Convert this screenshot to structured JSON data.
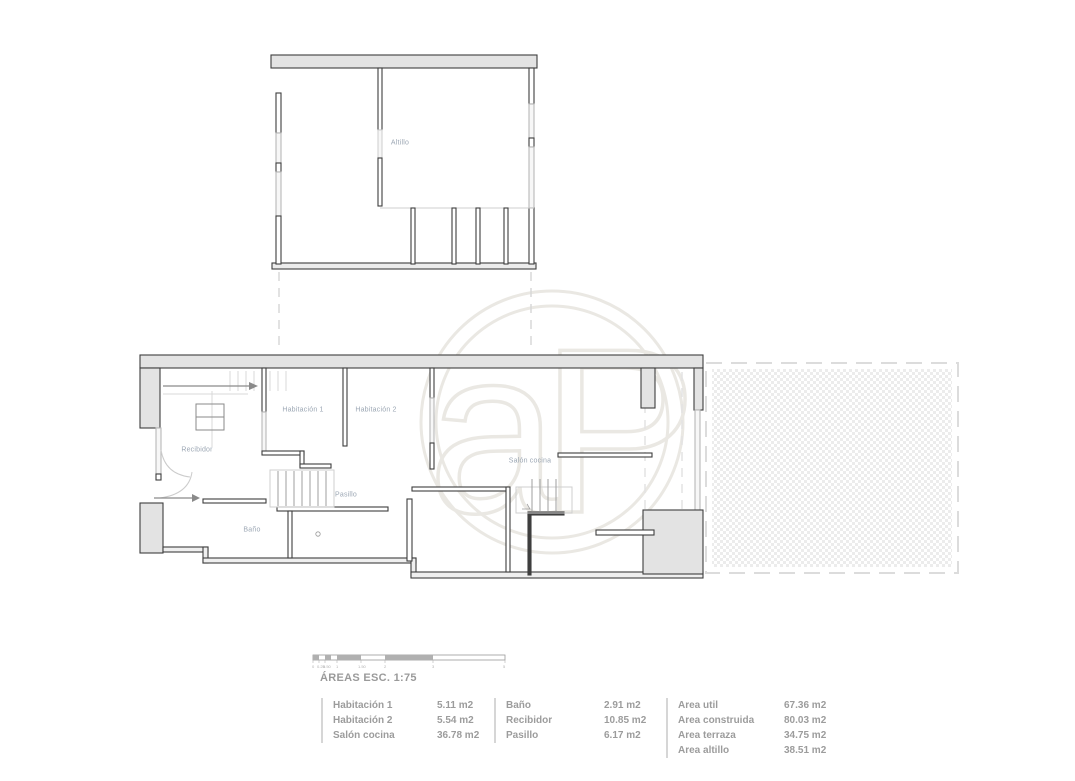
{
  "page": {
    "background": "#ffffff",
    "width": 1075,
    "height": 781
  },
  "watermark": {
    "letters": "aP",
    "color": "#eae8e3"
  },
  "plans": {
    "altillo": {
      "label": "Altillo"
    },
    "main": {
      "rooms": [
        {
          "name": "recibidor",
          "label": "Recibidor"
        },
        {
          "name": "habitacion-1",
          "label": "Habitación 1"
        },
        {
          "name": "habitacion-2",
          "label": "Habitación 2"
        },
        {
          "name": "pasillo",
          "label": "Pasillo"
        },
        {
          "name": "bano",
          "label": "Baño"
        },
        {
          "name": "salon-cocina",
          "label": "Salón cocina"
        }
      ]
    }
  },
  "legend": {
    "title": "ÁREAS ESC. 1:75",
    "scale_ticks": [
      "0",
      "0.25",
      "0.50",
      "1",
      "1.50",
      "2",
      "3",
      "5"
    ],
    "columns": [
      {
        "rows": [
          {
            "label": "Habitación 1",
            "value": "5.11 m2"
          },
          {
            "label": "Habitación 2",
            "value": "5.54 m2"
          },
          {
            "label": "Salón cocina",
            "value": "36.78 m2"
          }
        ]
      },
      {
        "rows": [
          {
            "label": "Baño",
            "value": "2.91 m2"
          },
          {
            "label": "Recibidor",
            "value": "10.85 m2"
          },
          {
            "label": "Pasillo",
            "value": "6.17 m2"
          }
        ]
      },
      {
        "rows": [
          {
            "label": "Area util",
            "value": "67.36 m2"
          },
          {
            "label": "Area construida",
            "value": "80.03 m2"
          },
          {
            "label": "Area terraza",
            "value": "34.75 m2"
          },
          {
            "label": "Area altillo",
            "value": "38.51 m2"
          }
        ]
      }
    ]
  },
  "colors": {
    "wall_fill": "#e4e4e4",
    "wall_line": "#3e3e3e",
    "window_line": "#b9b9b9",
    "room_label": "#9ca7b4",
    "legend_text": "#9c9c9c",
    "watermark": "#eae8e3",
    "terrace_dot": "#ececec"
  }
}
